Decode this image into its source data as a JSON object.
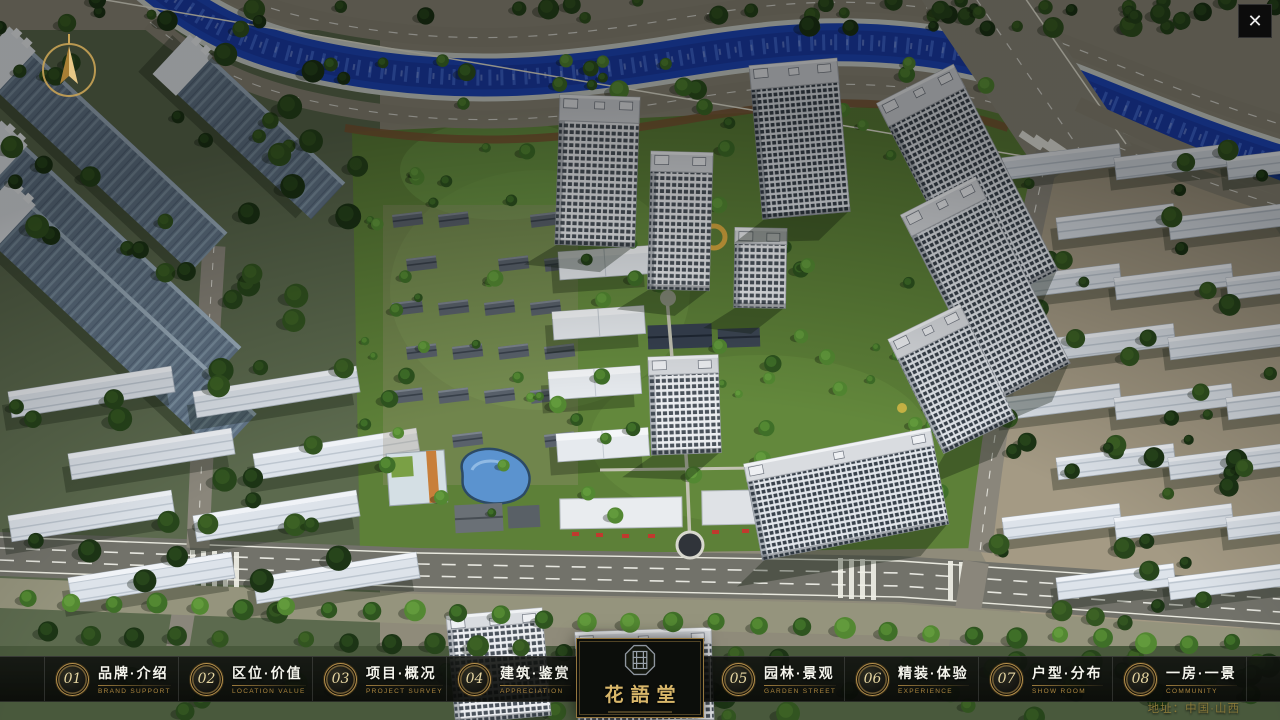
{
  "nav": {
    "items": [
      {
        "num": "01",
        "zh": "品牌·介绍",
        "en": "BRAND SUPPORT"
      },
      {
        "num": "02",
        "zh": "区位·价值",
        "en": "LOCATION VALUE"
      },
      {
        "num": "03",
        "zh": "项目·概况",
        "en": "PROJECT SURVEY"
      },
      {
        "num": "04",
        "zh": "建筑·鉴赏",
        "en": "APPRECIATION"
      },
      {
        "num": "05",
        "zh": "园林·景观",
        "en": "GARDEN STREET"
      },
      {
        "num": "06",
        "zh": "精装·体验",
        "en": "EXPERIENCE"
      },
      {
        "num": "07",
        "zh": "户型·分布",
        "en": "SHOW ROOM"
      },
      {
        "num": "08",
        "zh": "一房·一景",
        "en": "COMMUNITY"
      }
    ]
  },
  "logo": {
    "name": "花語堂"
  },
  "footer": {
    "address": "地址：中国·山西"
  },
  "window": {
    "close_glyph": "✕"
  },
  "colors": {
    "accent_gold": "#bb9750",
    "bar_background": "#0b0d0a",
    "river_blue": "#1e49c0",
    "site_green": "#5d8038"
  }
}
